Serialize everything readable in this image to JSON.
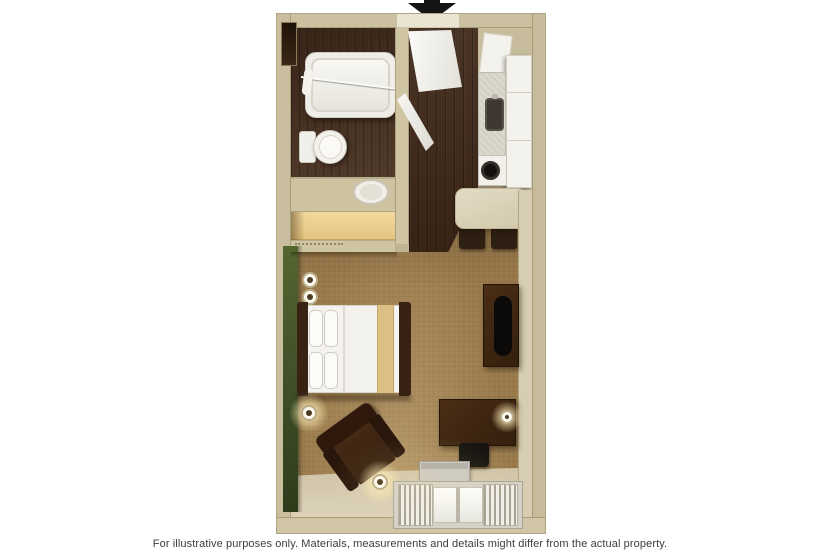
{
  "page": {
    "background_color": "#ffffff",
    "caption": "For illustrative purposes only.  Materials, measurements and details might differ from the actual property."
  },
  "icons": {
    "entrance_arrow": "black downward triangle marking the suite entrance at the top wall door opening"
  },
  "palette": {
    "wall_tan": "#cbc09f",
    "wall_edge": "#a79b77",
    "carpet_brown": "#9a7a4b",
    "entry_wood_dark": "#3f2818",
    "bathroom_wood": "#4a3221",
    "accent_wall_green": "#42522a",
    "closet_wood_light": "#eed397",
    "fixture_white": "#f3f2ed",
    "furniture_dark_brown": "#3a2414",
    "window_floor_light": "#dacfb4"
  },
  "floorplan": {
    "type": "studio suite floor plan, top-down 3D render",
    "rooms": [
      "bathroom",
      "closet-vanity",
      "entry",
      "kitchen",
      "main-living-sleeping-room"
    ],
    "furniture": [
      "bathtub",
      "shower-curtain-rod",
      "toilet",
      "vanity-sink",
      "closet-shelf-with-rod",
      "entry-door",
      "bathroom-door",
      "upper-cabinet",
      "refrigerator-cabinet",
      "kitchen-counter",
      "kitchen-sink",
      "stove",
      "dining-table",
      "dining-chairs",
      "queen-bed",
      "pillows",
      "wall-sconces",
      "tv-dresser",
      "desk",
      "desk-chair",
      "desk-lamp",
      "armchair-recliner",
      "floor-lamps",
      "air-conditioner",
      "window-with-curtains"
    ]
  }
}
